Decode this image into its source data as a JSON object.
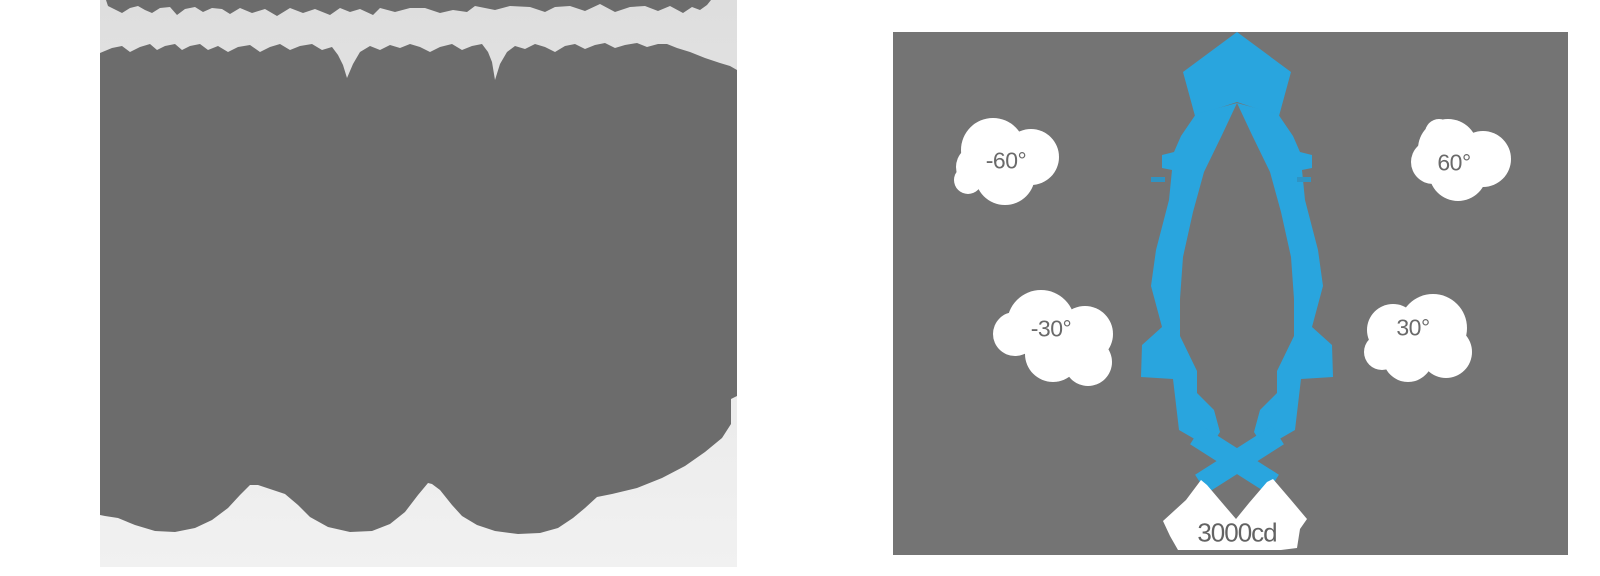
{
  "page": {
    "background": "#ffffff"
  },
  "left_image": {
    "description": "heavily degraded grayscale photo placeholder (abstract blobs)",
    "bg_top": "#dedede",
    "bg_bottom": "#f1f1f1",
    "ink": "#6c6c6c"
  },
  "beam_diagram": {
    "panel_bg": "#747474",
    "beam_color": "#29a5de",
    "label_bg": "#ffffff",
    "label_color": "#6a6a6a",
    "labels": [
      {
        "id": "neg60",
        "text": "-60°"
      },
      {
        "id": "pos60",
        "text": "60°"
      },
      {
        "id": "neg30",
        "text": "-30°"
      },
      {
        "id": "pos30",
        "text": "30°"
      },
      {
        "id": "intensity",
        "text": "3000cd"
      }
    ]
  },
  "chart_data": {
    "type": "line",
    "subtype": "polar luminous intensity distribution (photometric beam diagram)",
    "title": "",
    "angle_tick_labels": [
      "-60°",
      "-30°",
      "30°",
      "60°"
    ],
    "angle_ticks_deg": [
      -60,
      -30,
      30,
      60
    ],
    "intensity_scale_label": "3000cd",
    "max_intensity_cd": 3000,
    "beam_description": "narrow symmetric spot beam centered on 0° axis (pointing up), peak reaching 3000 cd ring",
    "grid": false,
    "legend": false,
    "colors": {
      "beam": "#29a5de",
      "panel": "#747474",
      "labels": "#6a6a6a"
    }
  }
}
